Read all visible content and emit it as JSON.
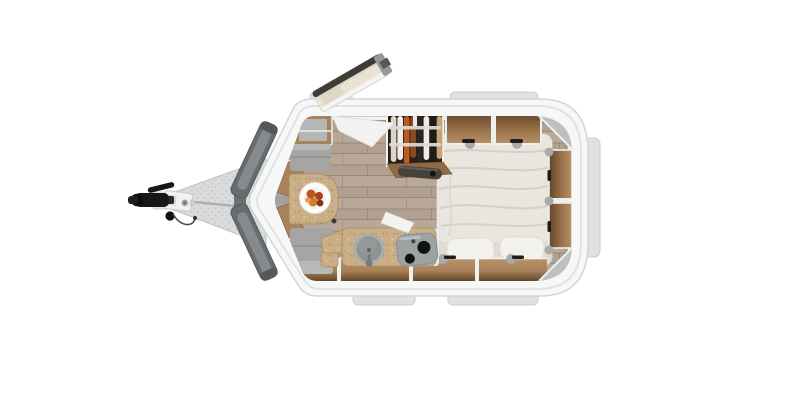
{
  "scene": {
    "view": "top-down floor plan of a single-axle teardrop camper trailer",
    "background": "#ffffff"
  },
  "labels": {
    "scene": "Camper trailer floor plan - top view",
    "trailer_body": "Trailer body shell",
    "drawbar": "A-frame drawbar",
    "hitch": "Tow hitch coupler with jockey bracket",
    "trim_tabs": "Exterior trim blocks",
    "front_panels": "Front exterior window panels",
    "door": "Open entry door",
    "floor": "Wood plank floor",
    "dinette": "Front dinette seating",
    "bench_top": "Bench seat",
    "bench_bottom": "Bench seat",
    "table": "Dinette table",
    "plate": "Plate with food",
    "corner_cabinet": "Front corner cabinet",
    "kitchen": "Kitchenette counter",
    "sink": "Round sink with faucet",
    "stove": "Cooktop with burners",
    "counter_flap": "Lifted counter flap",
    "wardrobe": "Wardrobe with hanging clothes",
    "dark_item": "Stowed bag",
    "overhead_shelves": "Overhead storage shelves",
    "rear_shelves": "Rear wall storage shelves",
    "bottom_shelves": "Lower wall storage shelves",
    "bed": "Double bed with duvet",
    "pillow_left": "Pillow",
    "pillow_right": "Pillow",
    "door_panel": "Inner door panel"
  },
  "colors": {
    "body": "#f6f7f7",
    "bodyEdge": "#d2d5d6",
    "wallSeam": "#e0e2e3",
    "wallBand": "#eef0f1",
    "wallInner": "#c2c5c6",
    "tab": "#e0e2e2",
    "tabEdge": "#cbcecf",
    "floorBase": "#b1a08f",
    "floorLight": "#bfafa0",
    "woodDark": "#63452a",
    "wood": "#8f6a44",
    "woodMid": "#a8825a",
    "woodLight": "#bb9266",
    "cork": "#c9ae86",
    "cushion": "#a5a5a3",
    "cushionSeam": "#8c8c8a",
    "cushionLight": "#b8b8b6",
    "bed": "#e9e6df",
    "duvet": "#ecc",
    "bedFold": "#d5d1c7",
    "pillow": "#f3f1eb",
    "mattress": "#e0dcd4",
    "metal": "#9da3a3",
    "metalDark": "#75797a",
    "sink": "#8e9293",
    "panelDark": "#696c6e",
    "panelMid": "#878a8c",
    "panelEdge": "#55585a",
    "doorFace": "#e9e4d1",
    "doorEdge": "#3d3c37",
    "doorUnder": "#f4f4f2",
    "wardrobe": "#262019",
    "rail": "#d9d9d7",
    "drawbar": "#d9dbdc",
    "drawbarDot": "#c3c6c7",
    "hitch": "#171717",
    "bracket": "#f0f1f1",
    "plate": "#fcfcfb",
    "food1": "#c0551e",
    "food2": "#a8431a",
    "food3": "#d07a30",
    "food4": "#7e3a14",
    "darkItem": "#474239",
    "divider": "#eef0f0",
    "grayShelf": "#bdc0c1"
  },
  "wardrobe_clothes": [
    "#ded5c2",
    "#efece6",
    "#bc5a1d",
    "#8a4a22",
    "#2c2520",
    "#efece6",
    "#1d1a17",
    "#c7a272"
  ]
}
